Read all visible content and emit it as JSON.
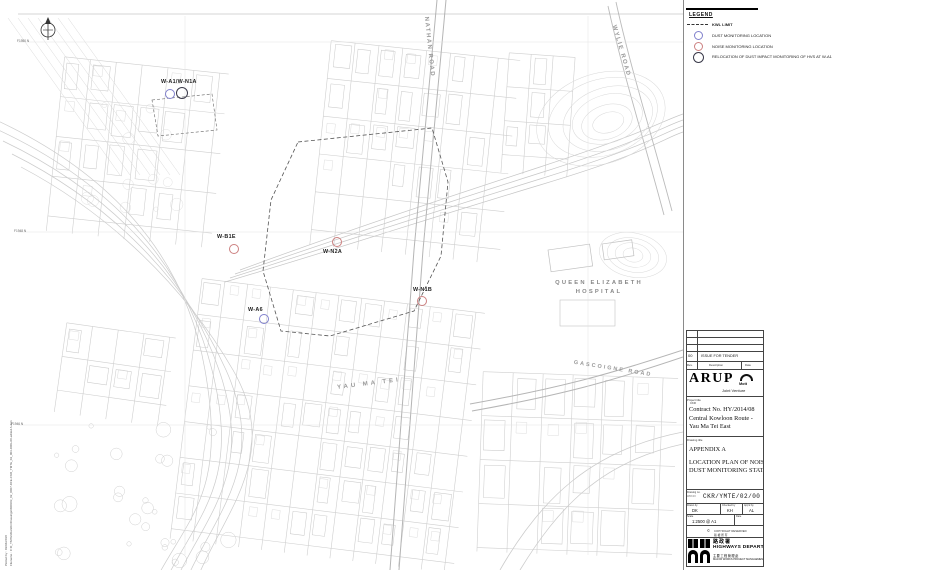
{
  "colors": {
    "dust_marker": "#8080cc",
    "noise_marker": "#cc8080",
    "relocation_marker": "#3a3a4a",
    "linework": "#cccccc"
  },
  "legend": {
    "title": "LEGEND",
    "items": [
      {
        "symbol": "dashed-line",
        "label": "KWL LIMIT"
      },
      {
        "symbol": "blue-circle",
        "label": "DUST MONITORING LOCATION"
      },
      {
        "symbol": "red-circle",
        "label": "NOISE MONITORING LOCATION"
      },
      {
        "symbol": "black-circle",
        "label": "RELOCATION OF DUST IMPACT MONITORING OF HVS AT W-A1"
      }
    ]
  },
  "map": {
    "stations": [
      {
        "name": "W-A1/W-N1A",
        "label_x": 161,
        "label_y": 79,
        "markers": [
          {
            "type": "dust",
            "x": 169,
            "y": 93
          },
          {
            "type": "relocation",
            "x": 181,
            "y": 92
          }
        ]
      },
      {
        "name": "W-B1E",
        "label_x": 217,
        "label_y": 234,
        "markers": [
          {
            "type": "noise",
            "x": 233,
            "y": 248
          }
        ]
      },
      {
        "name": "W-N2A",
        "label_x": 323,
        "label_y": 249,
        "markers": [
          {
            "type": "noise",
            "x": 336,
            "y": 241
          }
        ]
      },
      {
        "name": "W-N1B",
        "label_x": 413,
        "label_y": 287,
        "markers": [
          {
            "type": "noise",
            "x": 421,
            "y": 300
          }
        ]
      },
      {
        "name": "W-A6",
        "label_x": 248,
        "label_y": 307,
        "markers": [
          {
            "type": "dust",
            "x": 263,
            "y": 318
          }
        ]
      }
    ],
    "roads": [
      {
        "name": "NATHAN ROAD",
        "x": 429,
        "y": 47,
        "rotate": 84,
        "size": 6,
        "spacing": 1.5
      },
      {
        "name": "WYLIE ROAD",
        "x": 621,
        "y": 51,
        "rotate": 74,
        "size": 6,
        "spacing": 1.5
      },
      {
        "name": "GASCOIGNE ROAD",
        "x": 613,
        "y": 369,
        "rotate": 9,
        "size": 5.5,
        "spacing": 2
      },
      {
        "name": "YAU MA TEI",
        "x": 369,
        "y": 384,
        "rotate": -7,
        "size": 6,
        "spacing": 3
      }
    ],
    "places": [
      {
        "line1": "QUEEN ELIZABETH",
        "line2": "HOSPITAL",
        "x": 599,
        "y": 279
      }
    ],
    "grid_labels": [
      {
        "text": "F1950 N",
        "x": 17,
        "y": 39
      },
      {
        "text": "F1948 N",
        "x": 14,
        "y": 229
      },
      {
        "text": "F1946 N",
        "x": 11,
        "y": 422
      }
    ],
    "plot_info": {
      "line1": "Plotted by : 03/04/2018",
      "line2": "Filename : C:\\0_YMTE\\WorkDir\\Drawings\\WDK03_02_0007-DFE-CKR_YMTE_02_003-DRG-00-edited A.dgn"
    }
  },
  "title_block": {
    "revision": {
      "rev": "00",
      "description": "ISSUE FOR TENDER",
      "col_rev": "Rev.",
      "col_desc": "Description",
      "col_date": "Date"
    },
    "jv": {
      "arup": "ARUP",
      "partner": "Mott",
      "joint": "Joint Venture"
    },
    "project": {
      "label": "Project title",
      "sub": "CKR",
      "contract": "Contract No. HY/2014/08",
      "line1": "Central Kowloon Route -",
      "line2": "Yau Ma Tei East"
    },
    "drawing": {
      "label": "Drawing title",
      "appendix": "APPENDIX A",
      "line1": "LOCATION PLAN OF NOISE AND",
      "line2": "DUST MONITORING STATIONS"
    },
    "numbers": {
      "dwg_label": "Drawing no.",
      "dwg_sub": "WDK03",
      "dwg_no": "CKR/YMTE/02/00",
      "drawn_label": "Drawn by",
      "drawn": "DK",
      "checked_label": "Checked by",
      "checked": "KH",
      "approved_label": "App'd by",
      "approved": "AL",
      "scale_label": "Scale",
      "scale": "1:2500 @ A1",
      "date_label": "Date",
      "copyright": "COPYRIGHT RESERVED",
      "copyright_symbol": "©",
      "copyright_cn": "版 權 所 有"
    },
    "hwd": {
      "cn": "路政署",
      "en": "HIGHWAYS DEPARTMENT",
      "cn2": "主要工程管理處",
      "en2": "MAJOR WORKS PROJECT MANAGEMENT OFFICE"
    }
  }
}
